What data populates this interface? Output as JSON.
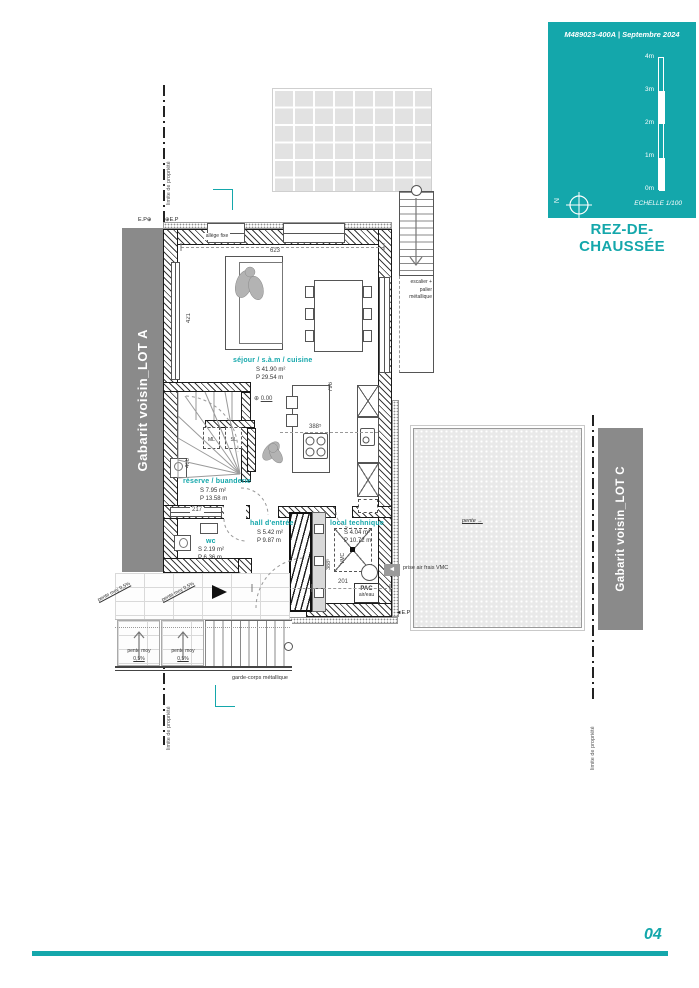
{
  "colors": {
    "accent": "#14a7ab",
    "gray_bar": "#8a8a8a"
  },
  "titleblock": {
    "ref": "M489023-400A | Septembre 2024",
    "scale_ticks": [
      "4m",
      "3m",
      "2m",
      "1m",
      "0m"
    ],
    "echelle": "ECHELLE  1/100",
    "north": "N"
  },
  "title": "REZ-DE-CHAUSSÉE",
  "page_number": "04",
  "neighbors": {
    "lot_a": "Gabarit voisin_LOT A",
    "lot_c": "Gabarit voisin_LOT C"
  },
  "property_line_label": "limite de propriété",
  "rooms": {
    "sejour": {
      "name": "séjour / s.à.m / cuisine",
      "s": "S  41.90 m²",
      "p": "P  29.54 m"
    },
    "reserve": {
      "name": "réserve / buanderie",
      "s": "S  7.95 m²",
      "p": "P  13.58 m"
    },
    "wc": {
      "name": "wc",
      "s": "S  2.19 m²",
      "p": "P  6.36 m"
    },
    "hall": {
      "name": "hall d'entrée",
      "s": "S  5.42 m²",
      "p": "P  9.87 m"
    },
    "local": {
      "name": "local technique",
      "s": "S  4.04 m²",
      "p": "P  10.72 m"
    }
  },
  "dims": {
    "top_width": "623",
    "left_height": "421",
    "mid_height": "796",
    "kitchen": "388⁵",
    "duct": "388⁵",
    "reserve_width": "217",
    "hall_width": "176",
    "local_width": "201",
    "stair_width": "400",
    "level": "0.00"
  },
  "annotations": {
    "allege": "allège fixe",
    "escalier_ext": "escalier + palier métallique",
    "garde_corps": "garde-corps métallique",
    "pente": "pente",
    "pente_moy_inline": "pente moy 0,5%",
    "pente_moy_l1": "pente moy",
    "pente_moy_l2": "0,5%",
    "prise_air": "prise air frais VMC",
    "pac_l1": "PAC",
    "pac_l2": "air/eau",
    "vmc": "VMC",
    "ep": "E.P",
    "ml": "ML",
    "sl": "SL"
  }
}
